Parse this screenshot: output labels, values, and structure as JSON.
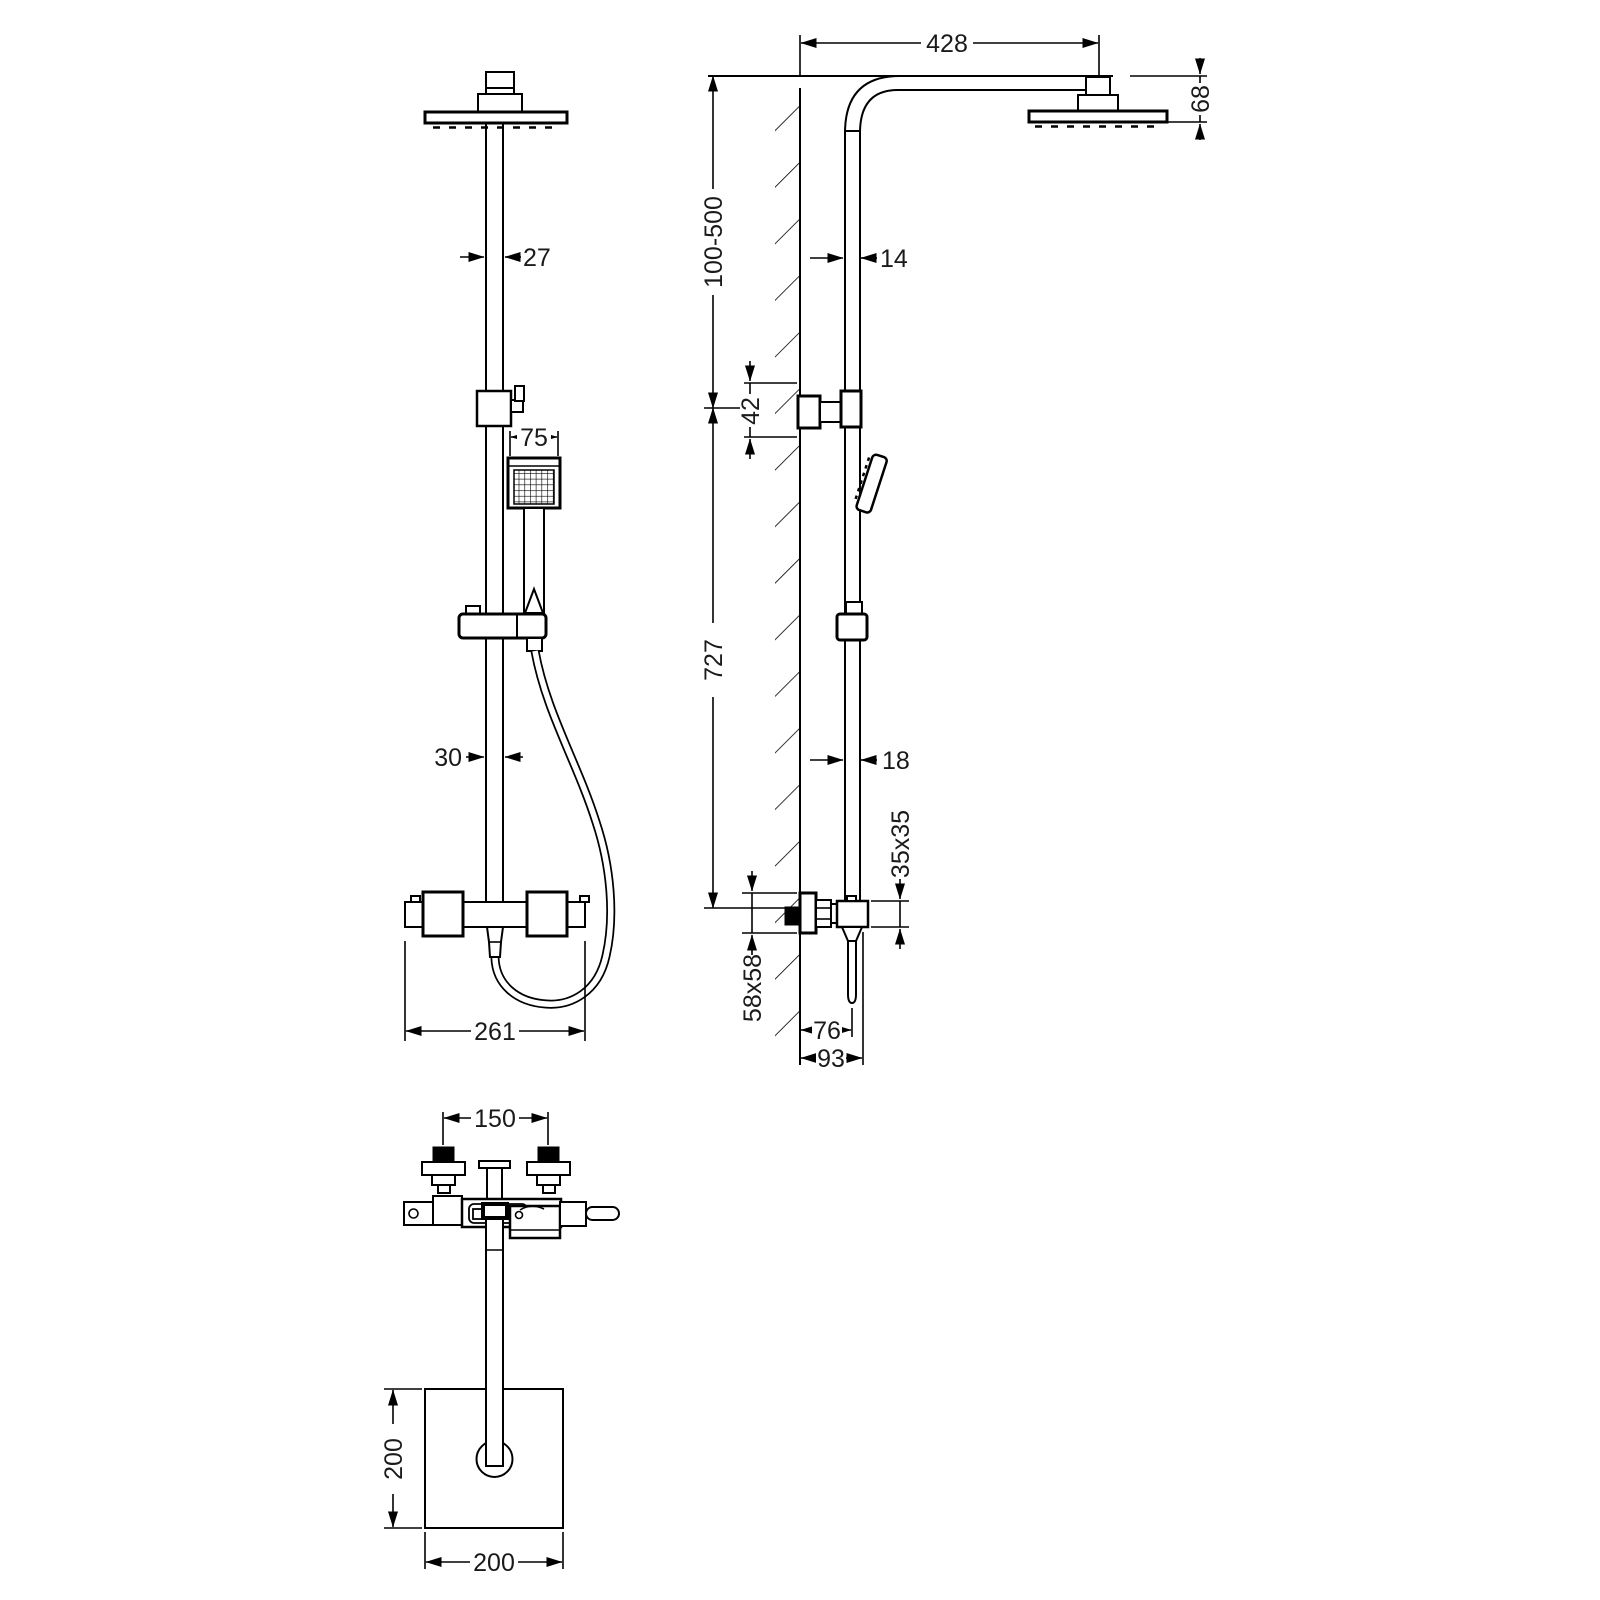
{
  "drawing": {
    "dims": {
      "front": {
        "arm_pipe_width": "27",
        "handset_width": "75",
        "riser_pipe_width": "30",
        "valve_width": "261"
      },
      "side": {
        "arm_projection": "428",
        "head_drop": "68",
        "height_adjustment": "100-500",
        "upper_pipe_width": "14",
        "wall_bracket_height": "42",
        "rail_length": "727",
        "lower_pipe_width": "18",
        "valve_body_square": "35x35",
        "wall_plate_square": "58x58",
        "handle_projection": "76",
        "valve_projection": "93"
      },
      "plan": {
        "inlet_centres": "150",
        "head_depth": "200",
        "head_width": "200"
      }
    },
    "colors": {
      "line": "#000000",
      "background": "#ffffff"
    }
  }
}
